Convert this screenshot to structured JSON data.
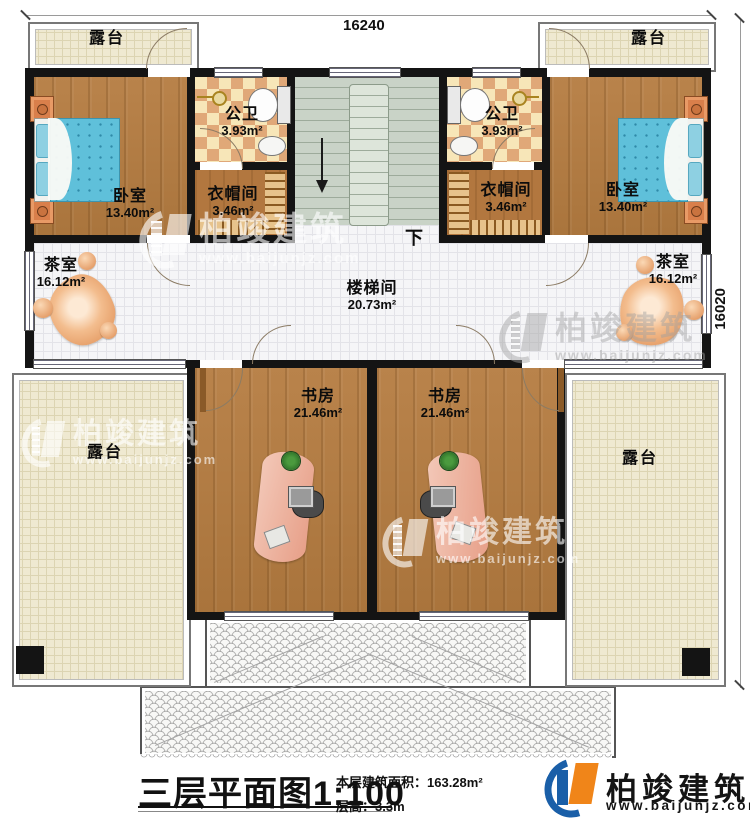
{
  "dimensions": {
    "top": "16240",
    "right": "16020"
  },
  "rooms": {
    "terrace": "露台",
    "bedroom": {
      "name": "卧室",
      "area": "13.40m²"
    },
    "bathroom": {
      "name": "公卫",
      "area": "3.93m²"
    },
    "cloakroom": {
      "name": "衣帽间",
      "area": "3.46m²"
    },
    "tearoom": {
      "name": "茶室",
      "area": "16.12m²"
    },
    "stairwell": {
      "name": "楼梯间",
      "area": "20.73m²"
    },
    "study": {
      "name": "书房",
      "area": "21.46m²"
    },
    "down": "下"
  },
  "title_block": {
    "title": "三层平面图",
    "scale": "1:100",
    "floor_area": "本层建筑面积：163.28m²",
    "floor_height": "层高：3.3m"
  },
  "brand": {
    "name": "柏竣建筑",
    "url": "www.baijunjz.com"
  },
  "colors": {
    "wall": "#141414",
    "wood_floor": "#b07a42",
    "tile_floor": "#f5f5f7",
    "terrace_floor": "#efe9d1",
    "stair_floor": "#c9d3c7",
    "bath_checker": "#e0a878",
    "bed_blue": "#5fc0da",
    "furniture_orange": "#dd8a4f",
    "desk_salmon": "#e79f88",
    "brand_blue": "#1a5fa8",
    "brand_orange": "#f08519"
  }
}
